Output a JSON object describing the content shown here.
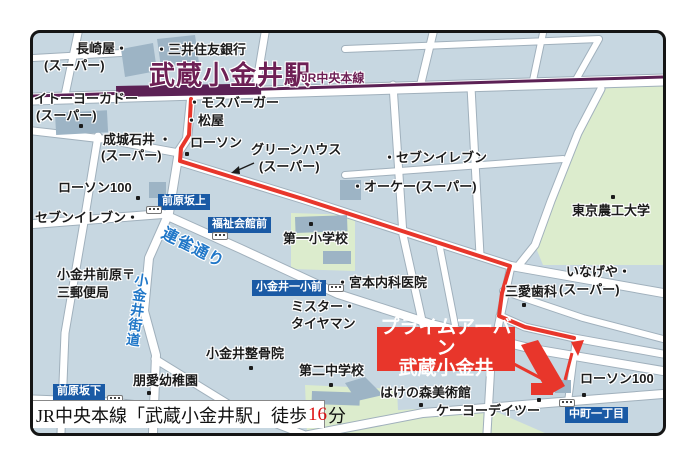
{
  "map": {
    "colors": {
      "land": "#c7d7e1",
      "road": "#ffffff",
      "road_casing": "#a0b0bc",
      "green_area": "#dceccd",
      "building": "#9db4c5",
      "railway_purple": "#5c2155",
      "station_text_purple": "#6e2055",
      "route_red": "#e8362b",
      "badge_blue": "#1a5aa5",
      "road_name_blue": "#2077c8",
      "caption_minutes_red": "#dd1111"
    },
    "railway": {
      "station_name": "武蔵小金井駅",
      "line_name": "JR中央本線"
    },
    "destination": {
      "name_line1": "プライムアーバン",
      "name_line2": "武蔵小金井"
    },
    "caption": {
      "text_before": "JR中央本線「武蔵小金井駅」徒歩",
      "minutes": "16",
      "text_after": "分"
    },
    "poi_labels": [
      {
        "name": "nagasakiya-line1",
        "text": "長崎屋・",
        "x": 76,
        "y": 42
      },
      {
        "name": "nagasakiya-line2",
        "text": "(スーパー)",
        "x": 44,
        "y": 59
      },
      {
        "name": "mitsui-sumitomo-bank",
        "text": "・三井住友銀行",
        "x": 155,
        "y": 43
      },
      {
        "name": "ito-yokado-line1",
        "text": "イトーヨーカドー",
        "x": 34,
        "y": 92
      },
      {
        "name": "ito-yokado-line2",
        "text": "(スーパー)",
        "x": 36,
        "y": 109
      },
      {
        "name": "mos-burger",
        "text": "・モスバーガー",
        "x": 188,
        "y": 96
      },
      {
        "name": "matsuya",
        "text": "・松屋",
        "x": 185,
        "y": 114
      },
      {
        "name": "seijo-ishii-line1",
        "text": "成城石井 ・",
        "x": 103,
        "y": 133
      },
      {
        "name": "seijo-ishii-line2",
        "text": "(スーパー)",
        "x": 101,
        "y": 149
      },
      {
        "name": "lawson-station",
        "text": "ローソン",
        "x": 190,
        "y": 136
      },
      {
        "name": "green-house-line1",
        "text": "グリーンハウス",
        "x": 251,
        "y": 143
      },
      {
        "name": "green-house-line2",
        "text": "(スーパー)",
        "x": 259,
        "y": 160
      },
      {
        "name": "seven-eleven-east",
        "text": "・セブンイレブン",
        "x": 383,
        "y": 151
      },
      {
        "name": "ok-super",
        "text": "・オーケー(スーパー)",
        "x": 351,
        "y": 180
      },
      {
        "name": "lawson100-west",
        "text": "ローソン100",
        "x": 58,
        "y": 181
      },
      {
        "name": "seven-eleven-west",
        "text": "セブンイレブン・",
        "x": 35,
        "y": 211
      },
      {
        "name": "dai1-elementary-school",
        "text": "第一小学校",
        "x": 283,
        "y": 232
      },
      {
        "name": "tokyo-nokodai-university",
        "text": "東京農工大学",
        "x": 572,
        "y": 204
      },
      {
        "name": "post-office-line1",
        "text": "小金井前原〒",
        "x": 57,
        "y": 268
      },
      {
        "name": "post-office-line2",
        "text": "三郵便局",
        "x": 57,
        "y": 286
      },
      {
        "name": "miyamoto-clinic",
        "text": "・宮本内科医院",
        "x": 336,
        "y": 276
      },
      {
        "name": "mr-tireman-line1",
        "text": "ミスター・",
        "x": 291,
        "y": 300
      },
      {
        "name": "mr-tireman-line2",
        "text": "タイヤマン",
        "x": 291,
        "y": 317
      },
      {
        "name": "inageya-line1",
        "text": "いなげや・",
        "x": 566,
        "y": 265
      },
      {
        "name": "inageya-line2",
        "text": "(スーパー)",
        "x": 559,
        "y": 283
      },
      {
        "name": "sanai-dental",
        "text": "三愛歯科",
        "x": 505,
        "y": 285
      },
      {
        "name": "koganei-seikotsuin",
        "text": "小金井整骨院",
        "x": 206,
        "y": 347
      },
      {
        "name": "dai2-junior-high",
        "text": "第二中学校",
        "x": 299,
        "y": 364
      },
      {
        "name": "hoai-kindergarten",
        "text": "朋愛幼稚園",
        "x": 133,
        "y": 374
      },
      {
        "name": "hakenomori-museum",
        "text": "はけの森美術館",
        "x": 380,
        "y": 386
      },
      {
        "name": "keiyo-d2",
        "text": "ケーヨーデイツー",
        "x": 436,
        "y": 404
      },
      {
        "name": "lawson100-southeast",
        "text": "ローソン100",
        "x": 580,
        "y": 372
      }
    ],
    "road_names": [
      {
        "name": "renjaku-dori",
        "text": "連雀通り",
        "x": 166,
        "y": 226,
        "fs": 16,
        "rot": 27,
        "vertical": false
      },
      {
        "name": "koganei-kaido",
        "text": "小金井街道",
        "x": 135,
        "y": 272,
        "fs": 14,
        "rot": 8,
        "vertical": true
      }
    ],
    "bus_stop_badges": [
      {
        "name": "maehara-sakaue",
        "text": "前原坂上",
        "x": 158,
        "y": 194
      },
      {
        "name": "fukushi-kaikan-mae",
        "text": "福祉会館前",
        "x": 208,
        "y": 217
      },
      {
        "name": "koganei-isshomae",
        "text": "小金井一小前",
        "x": 252,
        "y": 280
      },
      {
        "name": "maehara-sakashita",
        "text": "前原坂下",
        "x": 53,
        "y": 384
      },
      {
        "name": "nakamachi-itchome",
        "text": "中町一丁目",
        "x": 565,
        "y": 407
      }
    ],
    "bus_stop_icons": [
      {
        "x": 146,
        "y": 206
      },
      {
        "x": 212,
        "y": 232
      },
      {
        "x": 328,
        "y": 284
      },
      {
        "x": 107,
        "y": 395
      },
      {
        "x": 559,
        "y": 399
      }
    ],
    "poi_dots": [
      {
        "x": 185,
        "y": 152
      },
      {
        "x": 136,
        "y": 196
      },
      {
        "x": 79,
        "y": 124
      },
      {
        "x": 611,
        "y": 195
      },
      {
        "x": 309,
        "y": 222
      },
      {
        "x": 419,
        "y": 403
      },
      {
        "x": 537,
        "y": 398
      },
      {
        "x": 582,
        "y": 393
      },
      {
        "x": 249,
        "y": 366
      },
      {
        "x": 329,
        "y": 383
      },
      {
        "x": 147,
        "y": 391
      },
      {
        "x": 522,
        "y": 303
      }
    ]
  }
}
